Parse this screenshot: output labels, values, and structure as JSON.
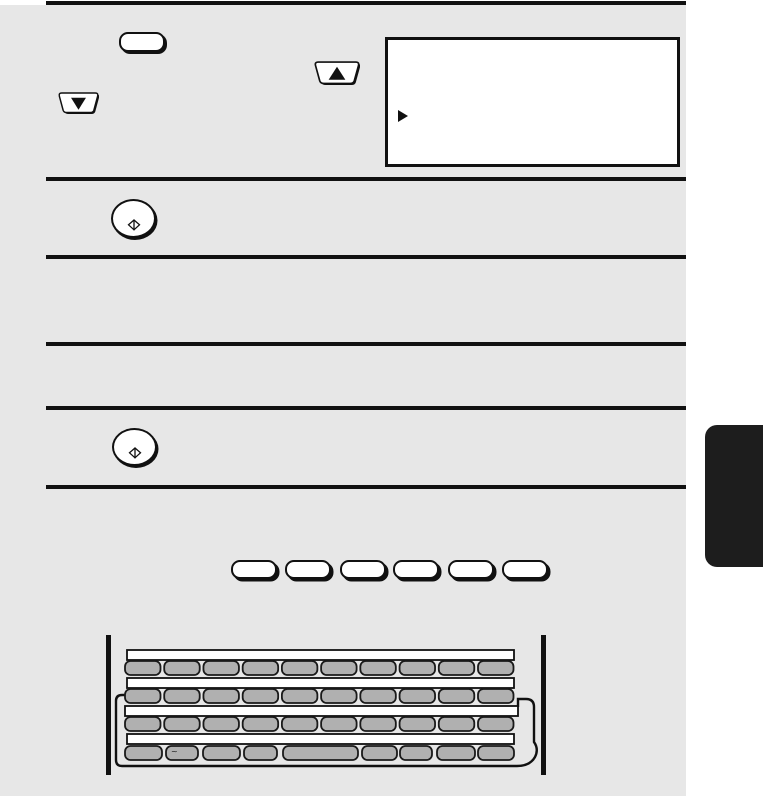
{
  "colors": {
    "page_background": "#e7e7e7",
    "paper_margin": "#ffffff",
    "ink": "#111111",
    "keyboard_key_fill": "#b0b0b0",
    "side_tab_fill": "#1d1d1d"
  },
  "section_rules": {
    "count": 6
  },
  "step_illustrations": {
    "blank_key_button": {
      "icon": "blank-rounded-key-icon"
    },
    "up_key": {
      "icon": "up-arrow-key-icon",
      "glyph": "▲"
    },
    "down_key": {
      "icon": "down-arrow-key-icon",
      "glyph": "▼"
    },
    "lcd_display": {
      "cursor_glyph": "▶",
      "icon": "lcd-display"
    },
    "start_keys": [
      {
        "icon": "start-diamond-icon"
      },
      {
        "icon": "start-diamond-icon"
      }
    ]
  },
  "function_key_row": {
    "count": 6,
    "xs": [
      231,
      285,
      340,
      393,
      448,
      502
    ]
  },
  "keyboard": {
    "rows": [
      {
        "count": 10
      },
      {
        "count": 10
      },
      {
        "count": 10
      },
      {
        "count": 9
      }
    ],
    "row_start_x": 125,
    "row_end_x": 513.5,
    "key_w": 35.5,
    "key_h": 14,
    "row_y": [
      661,
      689,
      717,
      746
    ],
    "row4": [
      {
        "x": 125,
        "w": 37
      },
      {
        "x": 166,
        "w": 32,
        "tilde": true
      },
      {
        "x": 203,
        "w": 37
      },
      {
        "x": 244,
        "w": 33
      },
      {
        "x": 283,
        "w": 75
      },
      {
        "x": 362,
        "w": 35
      },
      {
        "x": 400,
        "w": 32
      },
      {
        "x": 437,
        "w": 38
      },
      {
        "x": 478,
        "w": 36
      }
    ],
    "tilde_glyph": "~"
  }
}
